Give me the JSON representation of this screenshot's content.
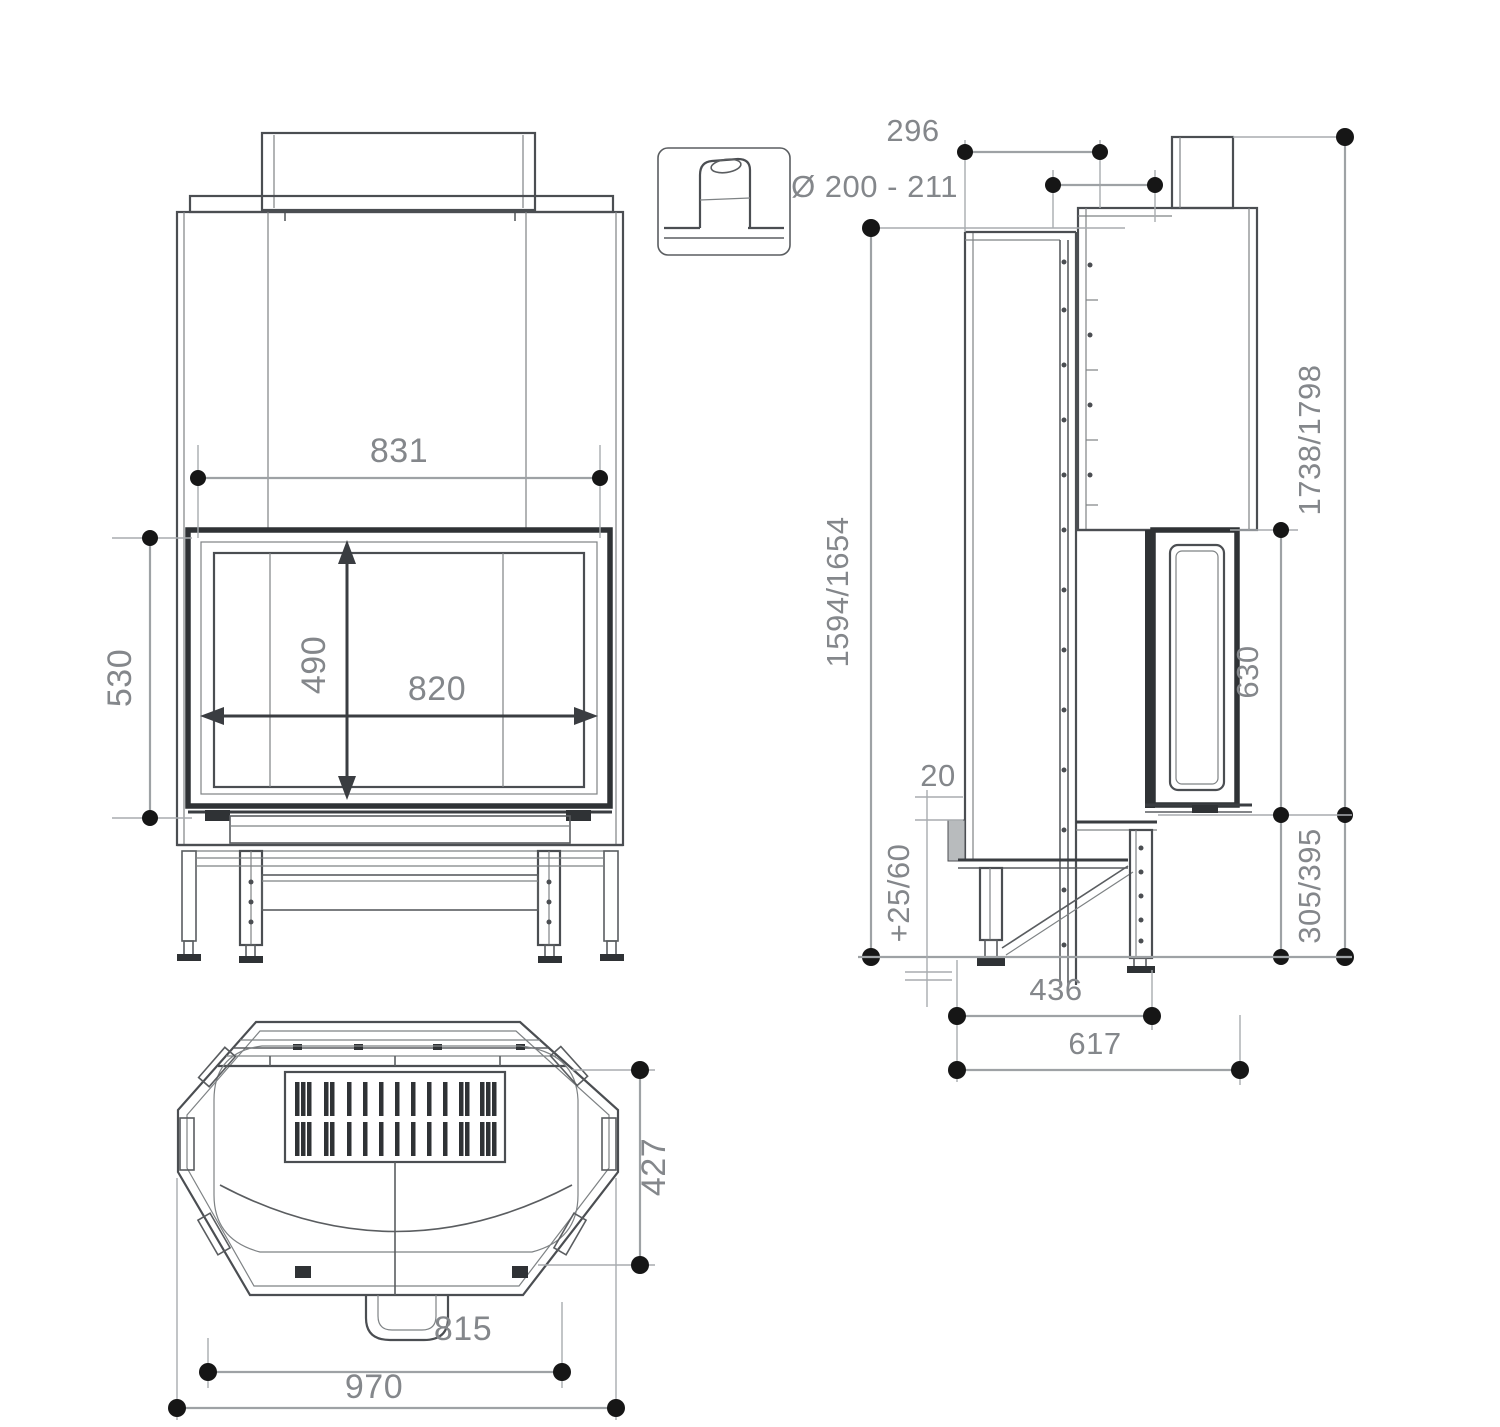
{
  "page": {
    "type": "technical-dimension-drawing",
    "subject": "fireplace insert — front, side, plan and flue-collar detail views",
    "background": "#ffffff"
  },
  "palette": {
    "object_line": "#4b4e52",
    "object_dark": "#2f3235",
    "dimension_line": "#9ea2a5",
    "dimension_text": "#84878b",
    "marker_dot": "#161616"
  },
  "views": {
    "front": {
      "name": "front-view",
      "dims": {
        "top_width": "831",
        "opening_height": "530",
        "glass_height": "490",
        "glass_width": "820"
      }
    },
    "detail": {
      "name": "flue-collar-detail"
    },
    "side": {
      "name": "side-view",
      "dims": {
        "flue_setback": "296",
        "flue_diameter": "Ø 200 - 211",
        "front_height": "1594/1654",
        "total_height": "1738/1798",
        "side_glass_height": "630",
        "hearth_lip": "20",
        "foot_adjustment": "+25/60",
        "base_height": "305/395",
        "foot_depth": "436",
        "total_depth": "617"
      }
    },
    "plan": {
      "name": "plan-view",
      "dims": {
        "depth": "427",
        "front_width": "815",
        "total_width": "970"
      }
    }
  }
}
